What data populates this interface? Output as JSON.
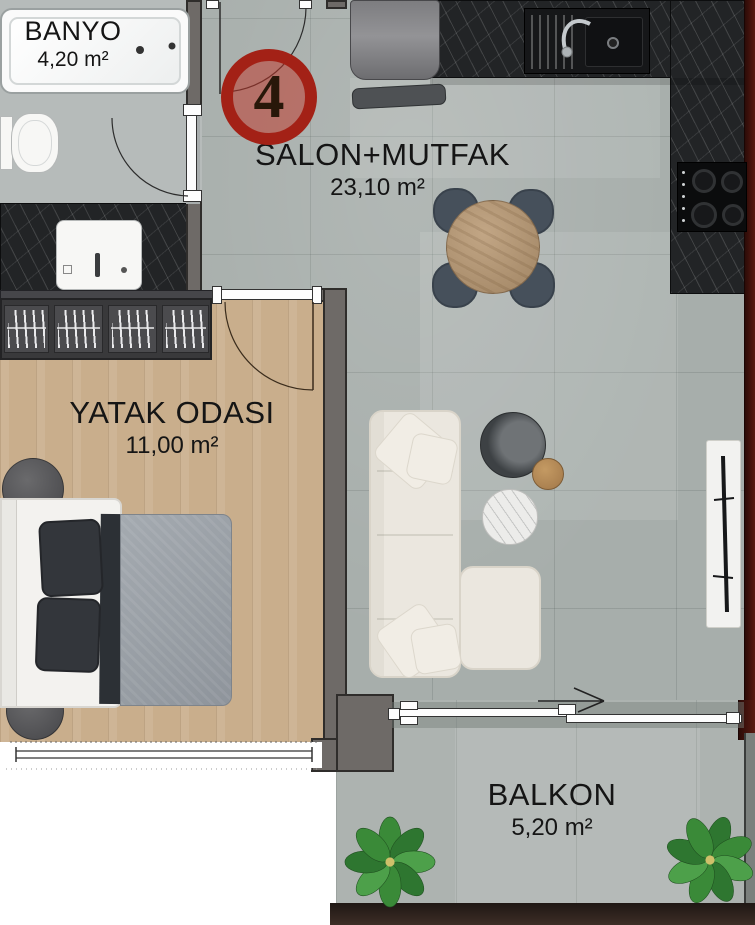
{
  "unit": {
    "number": "4"
  },
  "rooms": [
    {
      "id": "banyo",
      "name": "BANYO",
      "area": "4,20 m²"
    },
    {
      "id": "salon_mutfak",
      "name": "SALON+MUTFAK",
      "area": "23,10 m²"
    },
    {
      "id": "yatak_odasi",
      "name": "YATAK ODASI",
      "area": "11,00 m²"
    },
    {
      "id": "balkon",
      "name": "BALKON",
      "area": "5,20 m²"
    }
  ],
  "furniture": {
    "banyo": [
      "bathtub",
      "toilet",
      "washbasin",
      "vanity-counter"
    ],
    "salon_mutfak": [
      "kitchen-counter",
      "kitchen-sink",
      "faucet",
      "cooktop",
      "fridge",
      "bench",
      "dining-table",
      "four-chairs",
      "corner-sofa",
      "chaise",
      "coffee-table-dark",
      "coffee-table-marble",
      "side-table",
      "tv-console"
    ],
    "yatak_odasi": [
      "wardrobe-with-hangers",
      "double-bed",
      "pillows",
      "poufs",
      "window"
    ],
    "balkon": [
      "sliding-door",
      "plant",
      "plant"
    ]
  },
  "colors": {
    "floor_tile": "#a7aeab",
    "floor_wood": "#c9ae8c",
    "floor_bath": "#b6bbba",
    "counter_marble": "#222426",
    "wall_gray": "#6e6a67",
    "accent_wall_red": "#5a1a12",
    "badge_ring_red": "#a32116",
    "sofa_cream": "#ebe7df",
    "duvet_gray": "#9aa0a6",
    "chair_dark": "#46505b",
    "table_wood": "#b59878",
    "plant_green": "#3a8a38"
  }
}
